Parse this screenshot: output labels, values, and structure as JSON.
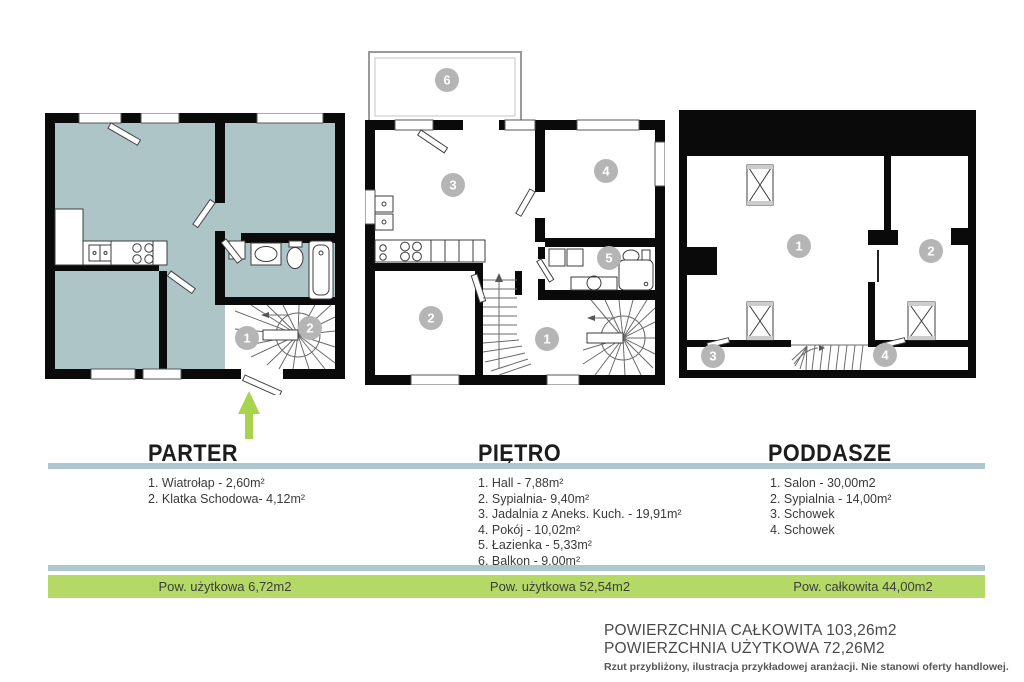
{
  "plans": {
    "parter": {
      "title": "PARTER",
      "rooms": [
        "1. Wiatrołap - 2,60m²",
        "2. Klatka Schodowa- 4,12m²"
      ],
      "markers": [
        "1",
        "2"
      ],
      "area_label": "Pow. użytkowa 6,72m2"
    },
    "pietro": {
      "title": "PIĘTRO",
      "rooms": [
        "1. Hall - 7,88m²",
        "2. Sypialnia- 9,40m²",
        "3. Jadalnia z Aneks. Kuch. - 19,91m²",
        "4. Pokój - 10,02m²",
        "5. Łazienka - 5,33m²",
        "6. Balkon - 9,00m²"
      ],
      "markers": [
        "1",
        "2",
        "3",
        "4",
        "5",
        "6"
      ],
      "area_label": "Pow. użytkowa 52,54m2"
    },
    "poddasze": {
      "title": "PODDASZE",
      "rooms": [
        "1. Salon -  30,00m2",
        "2. Sypialnia - 14,00m²",
        "3. Schowek",
        "4. Schowek"
      ],
      "markers": [
        "1",
        "2",
        "3",
        "4"
      ],
      "area_label": "Pow. całkowita 44,00m2"
    }
  },
  "summary": {
    "total_line": "POWIERZCHNIA CAŁKOWITA 103,26m2",
    "usable_line": "POWIERZCHNIA UŻYTKOWA 72,26M2",
    "disclaimer": "Rzut przybliżony, ilustracja przykładowej aranżacji. Nie stanowi oferty handlowej."
  },
  "colors": {
    "room_fill_teal": "#adc5c6",
    "accent_green": "#b4d967",
    "arrow_green": "#a9d24f",
    "divider_blue": "#aec6cd",
    "marker_gray": "#b5b5b5",
    "wall_black": "#0a0a0a"
  }
}
